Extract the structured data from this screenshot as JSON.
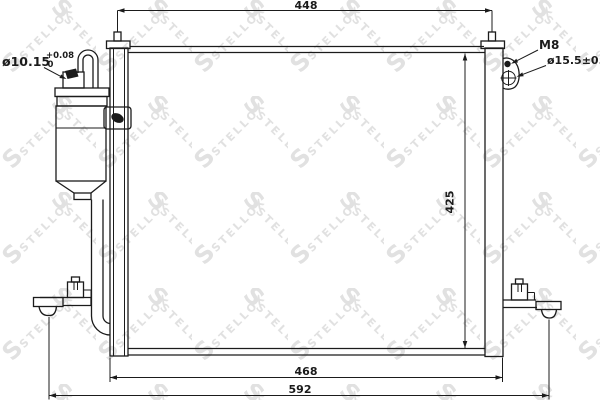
{
  "watermark": {
    "text": "STELLOX",
    "logo_letter": "S"
  },
  "colors": {
    "line": "#1b1b1b",
    "watermark": "#dcdcdc",
    "background": "#ffffff"
  },
  "dimensions": {
    "overall_top_width": "448",
    "core_height": "425",
    "mounting_width": "468",
    "overall_width": "592"
  },
  "callouts": {
    "drier_fitting_diameter": "ø10.15",
    "drier_fitting_tolerance_plus": "+0.08",
    "drier_fitting_tolerance_minus": "0",
    "mounting_bolt_thread": "M8",
    "port_diameter": "ø15.5±0.1"
  }
}
